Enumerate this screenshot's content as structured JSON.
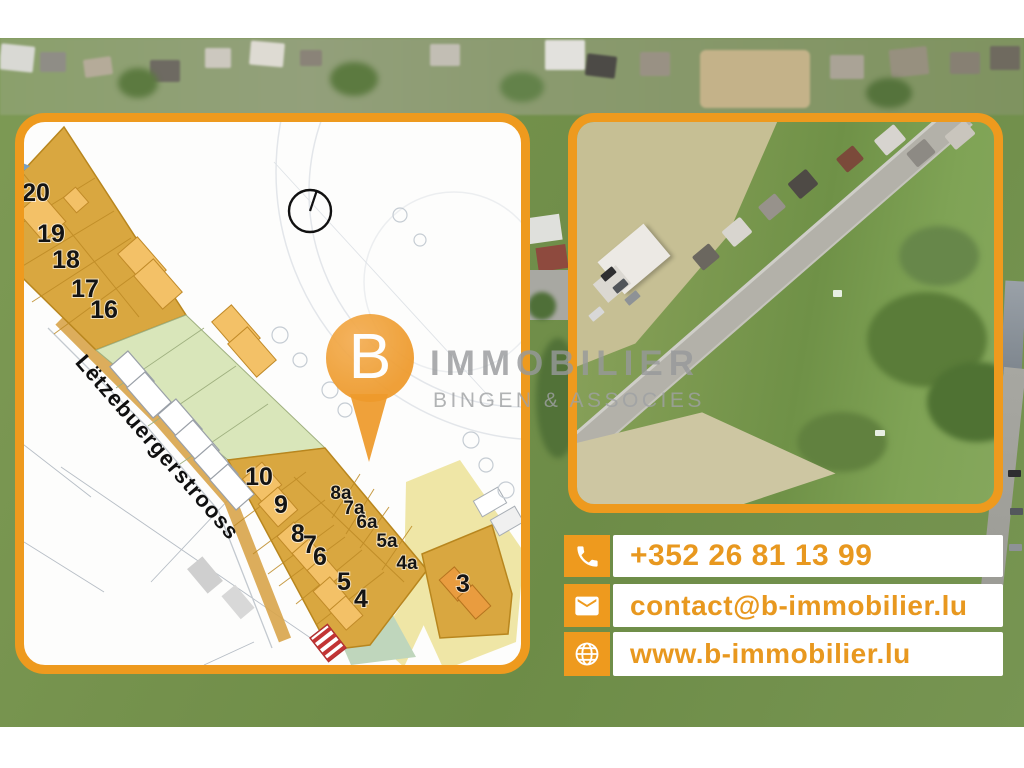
{
  "brand": {
    "pin_letter": "B",
    "name": "IMMOBILIER",
    "subtitle": "BINGEN & ASSOCIES"
  },
  "contact": {
    "phone": "+352 26 81 13 99",
    "email": "contact@b-immobilier.lu",
    "website": "www.b-immobilier.lu"
  },
  "site_plan": {
    "street_name": "Lëtzebuergerstrooss",
    "lot_labels": [
      "20",
      "19",
      "18",
      "17",
      "16",
      "10",
      "9",
      "8",
      "7",
      "6",
      "8a",
      "7a",
      "6a",
      "5a",
      "4a",
      "5",
      "4",
      "3"
    ]
  },
  "colors": {
    "accent_orange": "#EE9A1E",
    "contact_text_orange": "#E8981F",
    "lot_fill": "#D9A740",
    "lot_house": "#F3C167",
    "green_zone": "#D9E6BA",
    "pale_yellow": "#EFE6A6",
    "watermark_gray": "#97999B",
    "pin_orange": "#EE9A2B"
  }
}
